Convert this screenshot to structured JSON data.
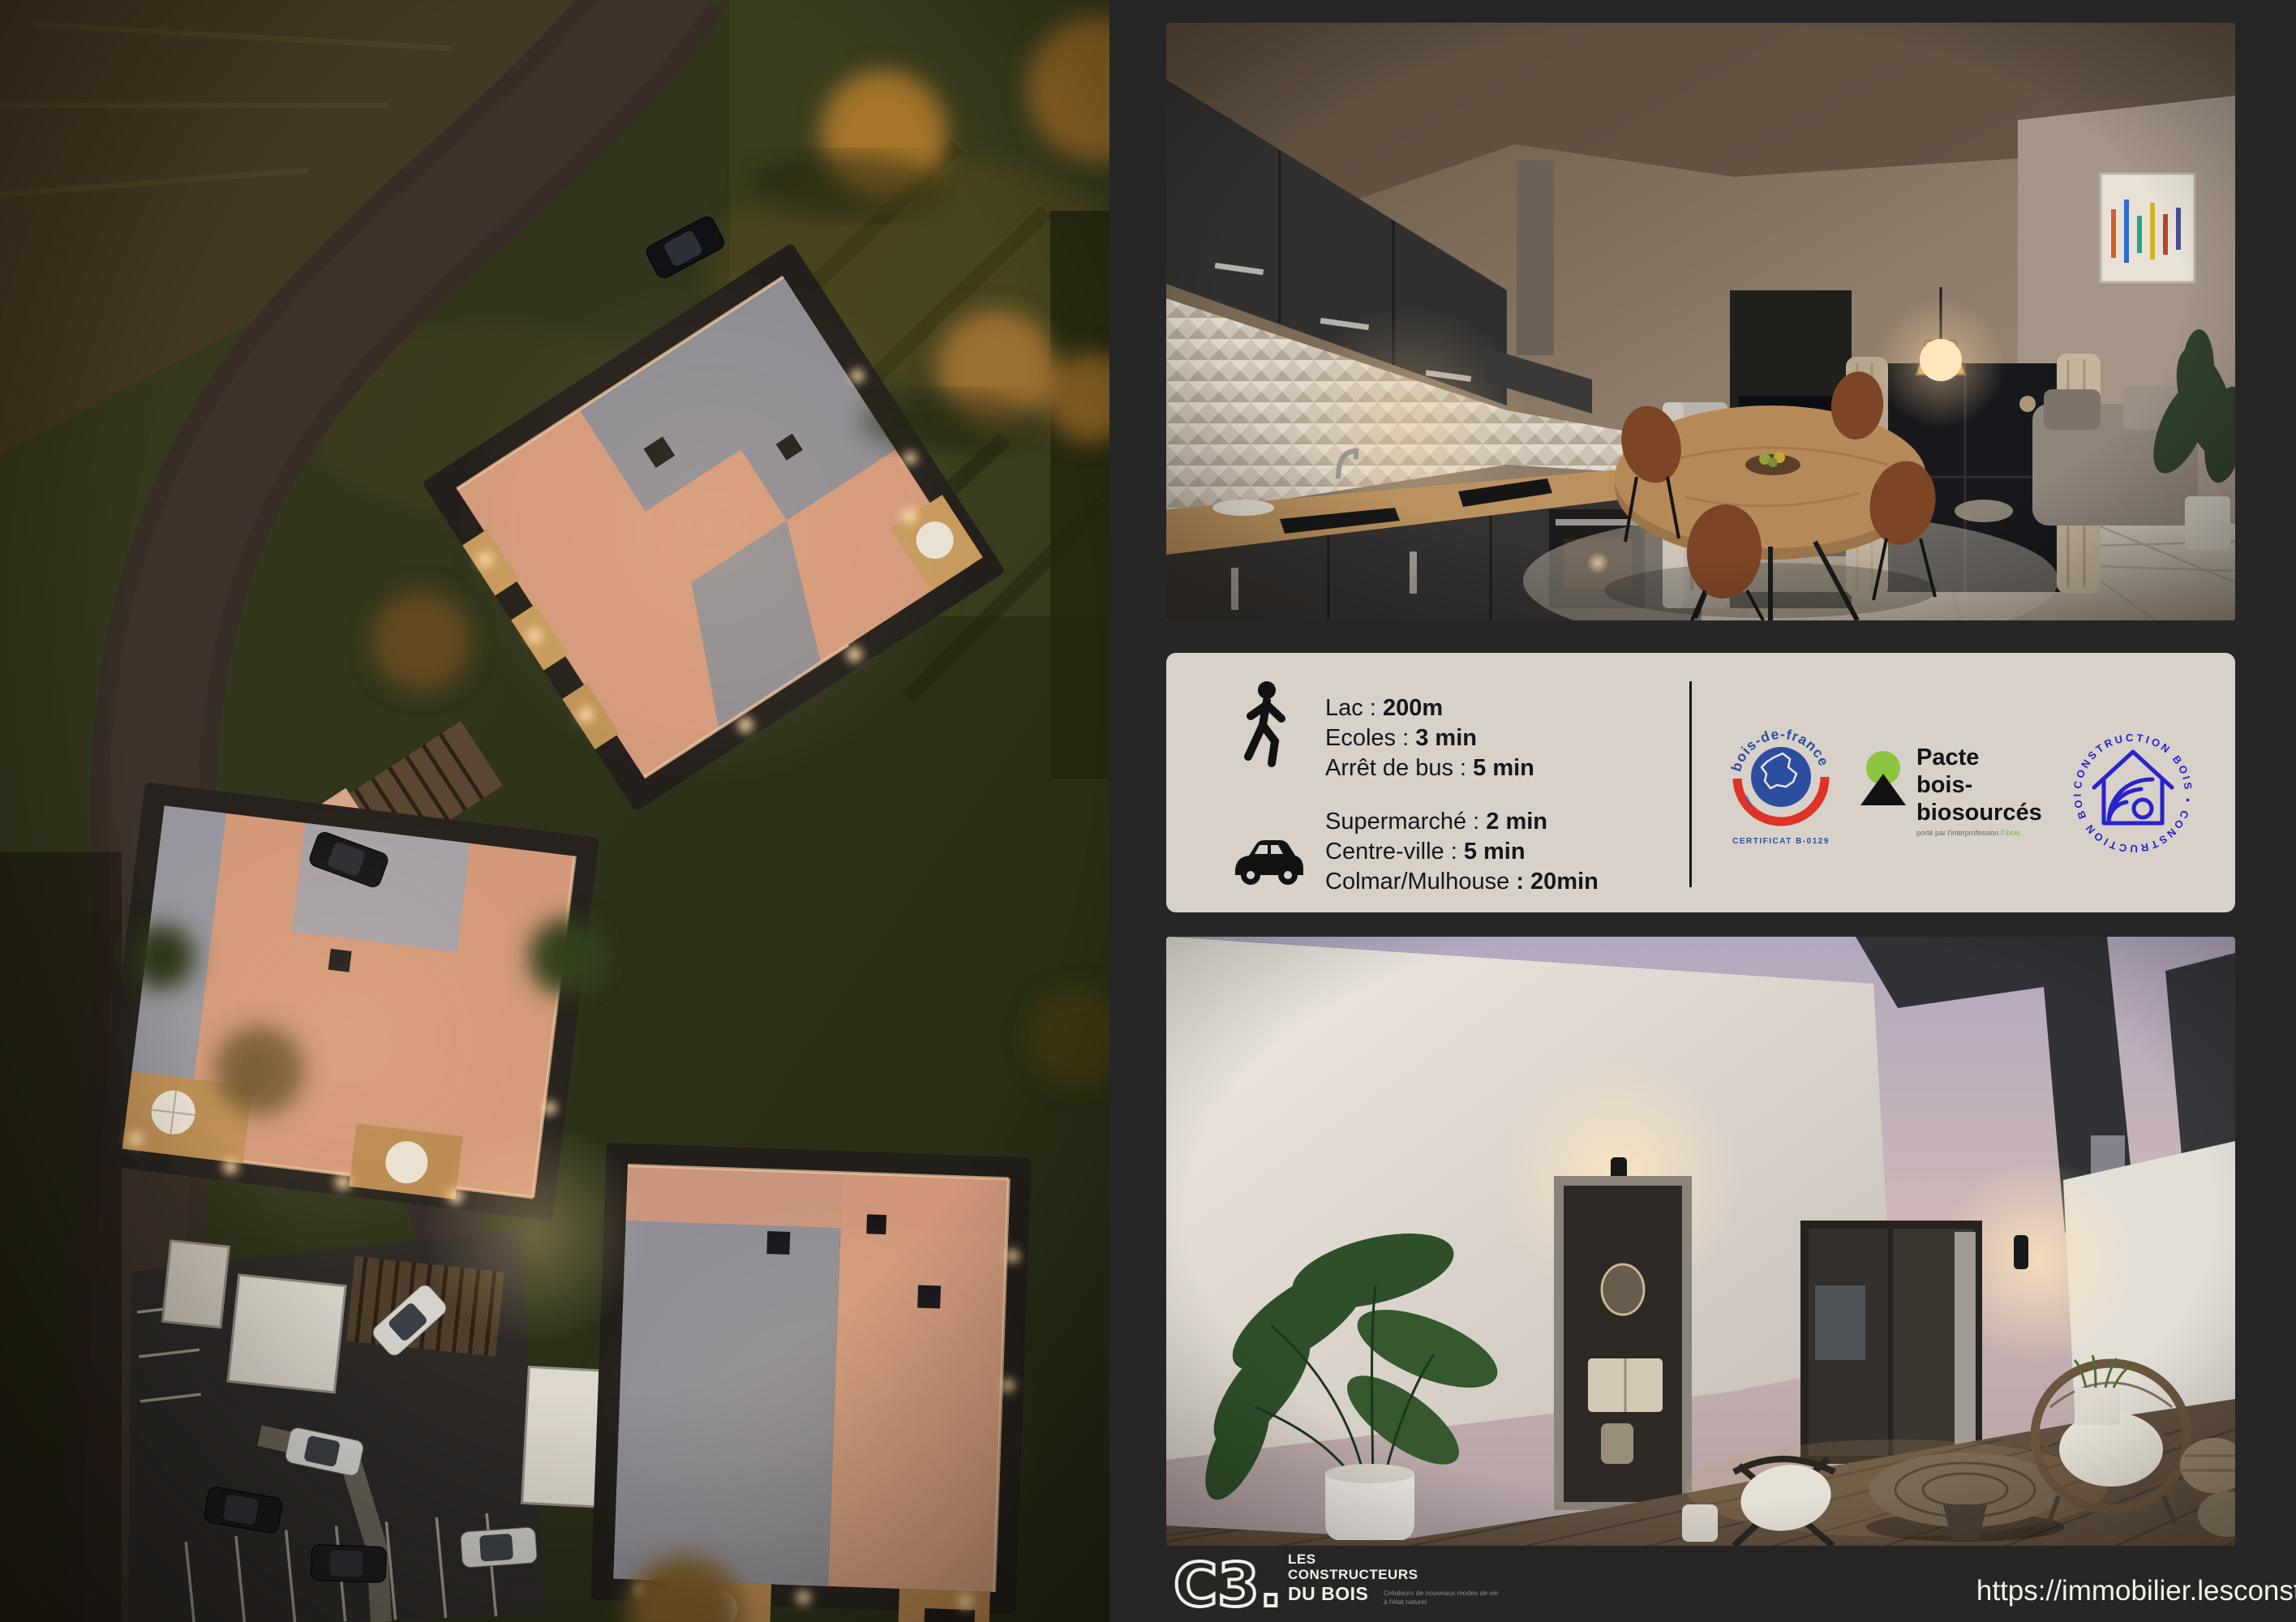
{
  "flyer": {
    "background": "#262627",
    "panel_bg": "#d7d1ca"
  },
  "info_panel": {
    "walking": {
      "rows": [
        {
          "label": "Lac : ",
          "value": "200m"
        },
        {
          "label": "Ecoles : ",
          "value": "3 min"
        },
        {
          "label": "Arrêt de bus : ",
          "value": "5 min"
        }
      ]
    },
    "driving": {
      "rows": [
        {
          "label": "Supermarché : ",
          "value": "2 min"
        },
        {
          "label": "Centre-ville  : ",
          "value": "5 min"
        },
        {
          "label": "Colmar/Mulhouse ",
          "value": ": 20min"
        }
      ]
    }
  },
  "logos": {
    "bois_de_france": {
      "arc_text": "bois-de-france",
      "certificate": "CERTIFICAT B-0129",
      "blue": "#2d4e9e",
      "red": "#df3228"
    },
    "pacte": {
      "line1": "Pacte",
      "line2": "bois-",
      "line3": "biosourcés",
      "subtext": "porté par l'interprofession ",
      "subtext_accent": "Fibois",
      "green": "#8bc53f"
    },
    "construction_bois": {
      "stamp_text": "CONSTRUCTION BOIS • CONSTRUCTION BOIS •",
      "blue": "#2a22cc"
    }
  },
  "footer": {
    "logo_mark": "C3.",
    "brand": [
      "LES",
      "CONSTRUCTEURS",
      "DU BOIS"
    ],
    "tagline": [
      "Créateurs de nouveaux modes de vie",
      "à l'état naturel"
    ],
    "url": "https://immobilier.lesconstructeursdubois.fr/"
  }
}
